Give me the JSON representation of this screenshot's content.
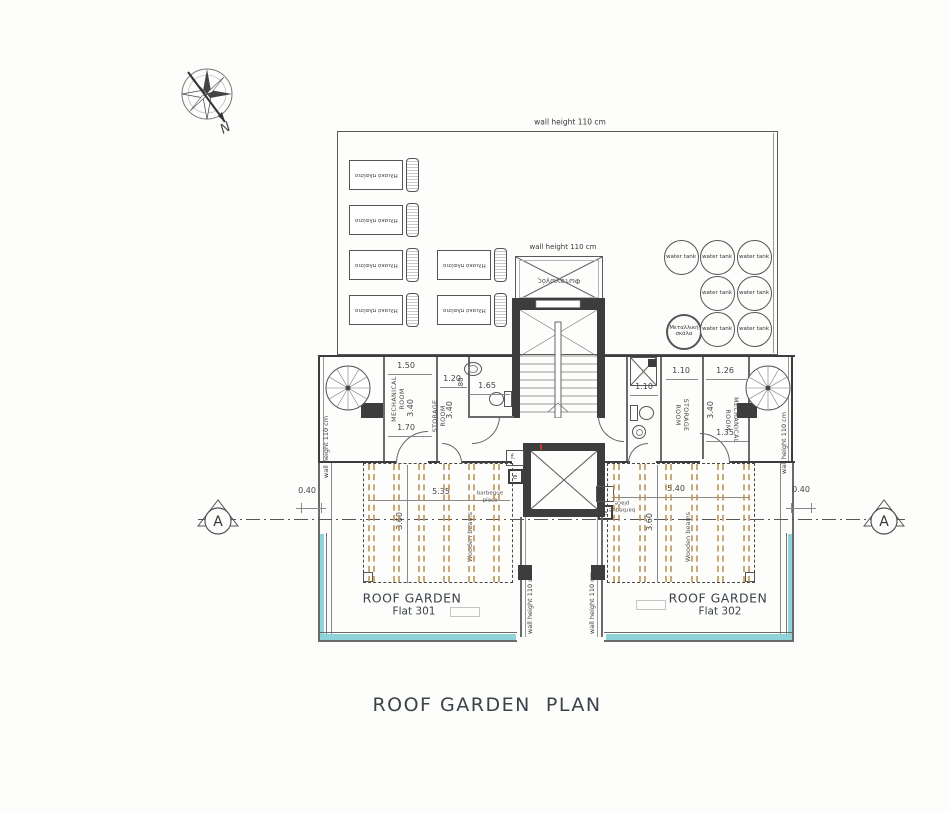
{
  "title": "ROOF GARDEN  PLAN",
  "compass": {
    "north_label": "N"
  },
  "wall_height_note": "wall height 110 cm",
  "skylight_label": "Φωταγωγός",
  "solar_panel_label": "Ηλιακό πλαίσιο",
  "water_tank_label": "water tank",
  "metal_ladder_label": "Μεταλλική σκάλα",
  "section_marker": "A",
  "fixtures": {
    "f": "f.",
    "e": "e"
  },
  "rooms": {
    "left_mechanical": {
      "label": "MECHANICAL ROOM",
      "dim_top": "1.50",
      "dim_bottom": "1.70",
      "dim_depth": "3.40"
    },
    "left_storage": {
      "label": "STORAGE ROOM",
      "dim_top": "1.20",
      "dim_depth": "3.40"
    },
    "left_bath": {
      "dim_width": "1.65",
      "dim_door": ".80"
    },
    "right_bath": {
      "dim_width": "1.10"
    },
    "right_storage": {
      "label": "STORAGE ROOM",
      "dim_top": "1.10"
    },
    "right_mechanical": {
      "label": "MECHANICAL ROOM",
      "dim_top": "1.26",
      "dim_bottom": "1.35",
      "dim_depth": "3.40"
    }
  },
  "gardens": {
    "left": {
      "title": "ROOF GARDEN",
      "flat": "Flat 301",
      "dim_width": "5.35",
      "dim_depth": "3.60",
      "dim_edge": "0.40",
      "beams_label": "Wooden beams",
      "barbeque_label": "barbeque place"
    },
    "right": {
      "title": "ROOF GARDEN",
      "flat": "Flat 302",
      "dim_width": "5.40",
      "dim_depth": "3.60",
      "dim_edge": "0.40",
      "beams_label": "Wooden beams",
      "barbeque_label": "barbeque place"
    }
  },
  "colors": {
    "wall": "#3d3d3d",
    "beam": "#bb9259",
    "glass": "#8fd3da"
  }
}
